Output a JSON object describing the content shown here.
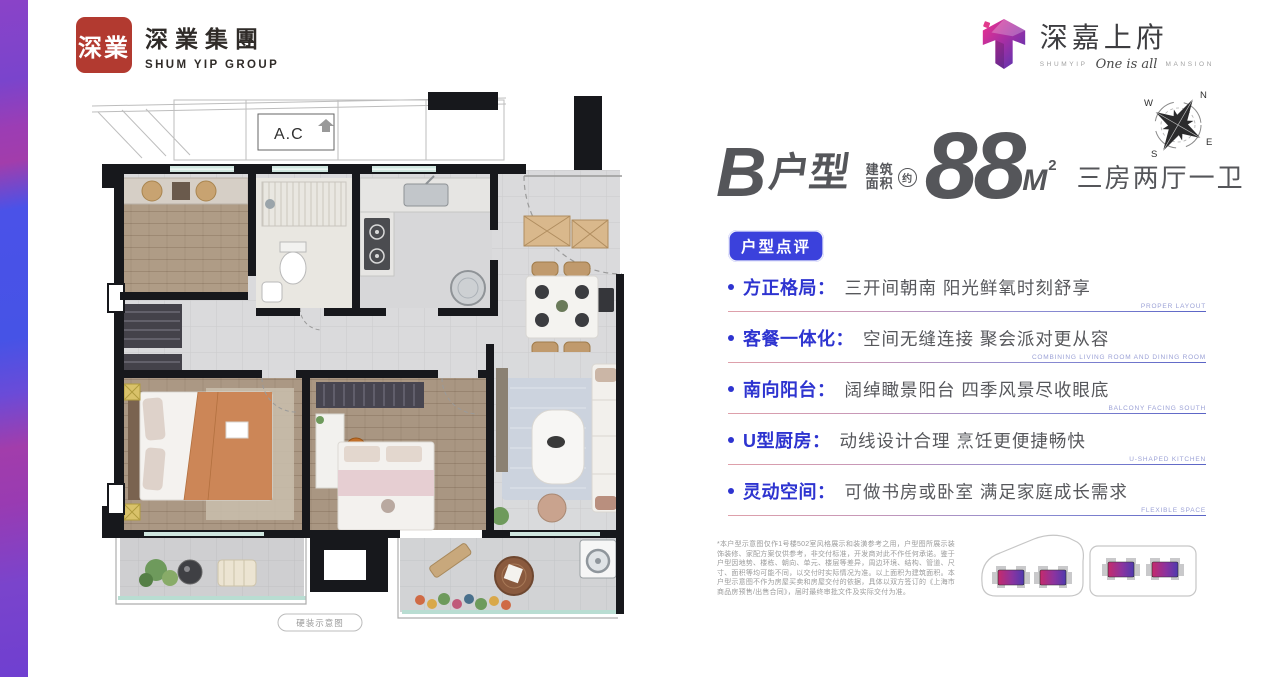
{
  "brand": {
    "group_logo": {
      "seal": "深業",
      "name_cn": "深業集團",
      "name_en": "SHUM YIP GROUP"
    },
    "project_logo": {
      "name_cn": "深嘉上府",
      "sub_prefix": "SHUMYIP",
      "sub_script": "One is all",
      "sub_suffix": "MANSION"
    }
  },
  "compass": {
    "n": "N",
    "e": "E",
    "s": "S",
    "w": "W"
  },
  "floorplan": {
    "ac_label": "A.C",
    "caption": "硬装示意图"
  },
  "headline": {
    "unit_letter": "B",
    "unit_word": "户型",
    "area_label_line1": "建筑",
    "area_label_line2": "面积",
    "area_approx": "约",
    "area_value": "88",
    "area_unit": "M",
    "area_exponent": "2",
    "layout_text": "三房两厅一卫"
  },
  "review": {
    "badge": "户型点评",
    "items": [
      {
        "label": "方正格局：",
        "desc": "三开间朝南 阳光鲜氧时刻舒享",
        "en": "PROPER LAYOUT"
      },
      {
        "label": "客餐一体化：",
        "desc": "空间无缝连接 聚会派对更从容",
        "en": "COMBINING LIVING ROOM AND DINING ROOM"
      },
      {
        "label": "南向阳台：",
        "desc": "阔绰瞰景阳台 四季风景尽收眼底",
        "en": "BALCONY FACING SOUTH"
      },
      {
        "label": "U型厨房：",
        "desc": "动线设计合理 烹饪更便捷畅快",
        "en": "U-SHAPED KITCHEN"
      },
      {
        "label": "灵动空间：",
        "desc": "可做书房或卧室 满足家庭成长需求",
        "en": "FLEXIBLE SPACE"
      }
    ]
  },
  "disclaimer": "*本户型示意图仅作1号楼502室风格展示和装潢参考之用，户型图所展示装饰装修、家配方案仅供参考，非交付标准，开发商对此不作任何承诺。鉴于户型因地势、楼栋、朝向、单元、楼层等差异，周边环境、结构、管道、尺寸、面积等均可能不同，以交付时实际情况为准。以上面积为建筑面积。本户型示意图不作为房屋买卖和房屋交付的依据，具体以双方签订的《上海市商品房预售/出售合同》，届时最终审批文件及实际交付为准。",
  "colors": {
    "accent_blue": "#2e34d0",
    "badge_blue": "#3b41dc",
    "headline_gray": "#55565a",
    "seal_red": "#b23a30",
    "stripe_purple": "#7a44cc",
    "stripe_magenta": "#a23dab",
    "stripe_blue": "#4a52e8",
    "unit_gradient_start": "#c62a6c",
    "unit_gradient_end": "#4f3aae",
    "divider_pink": "#dfa0aa",
    "divider_blue": "#5a64c6",
    "english_caption": "#9ba1d6"
  }
}
